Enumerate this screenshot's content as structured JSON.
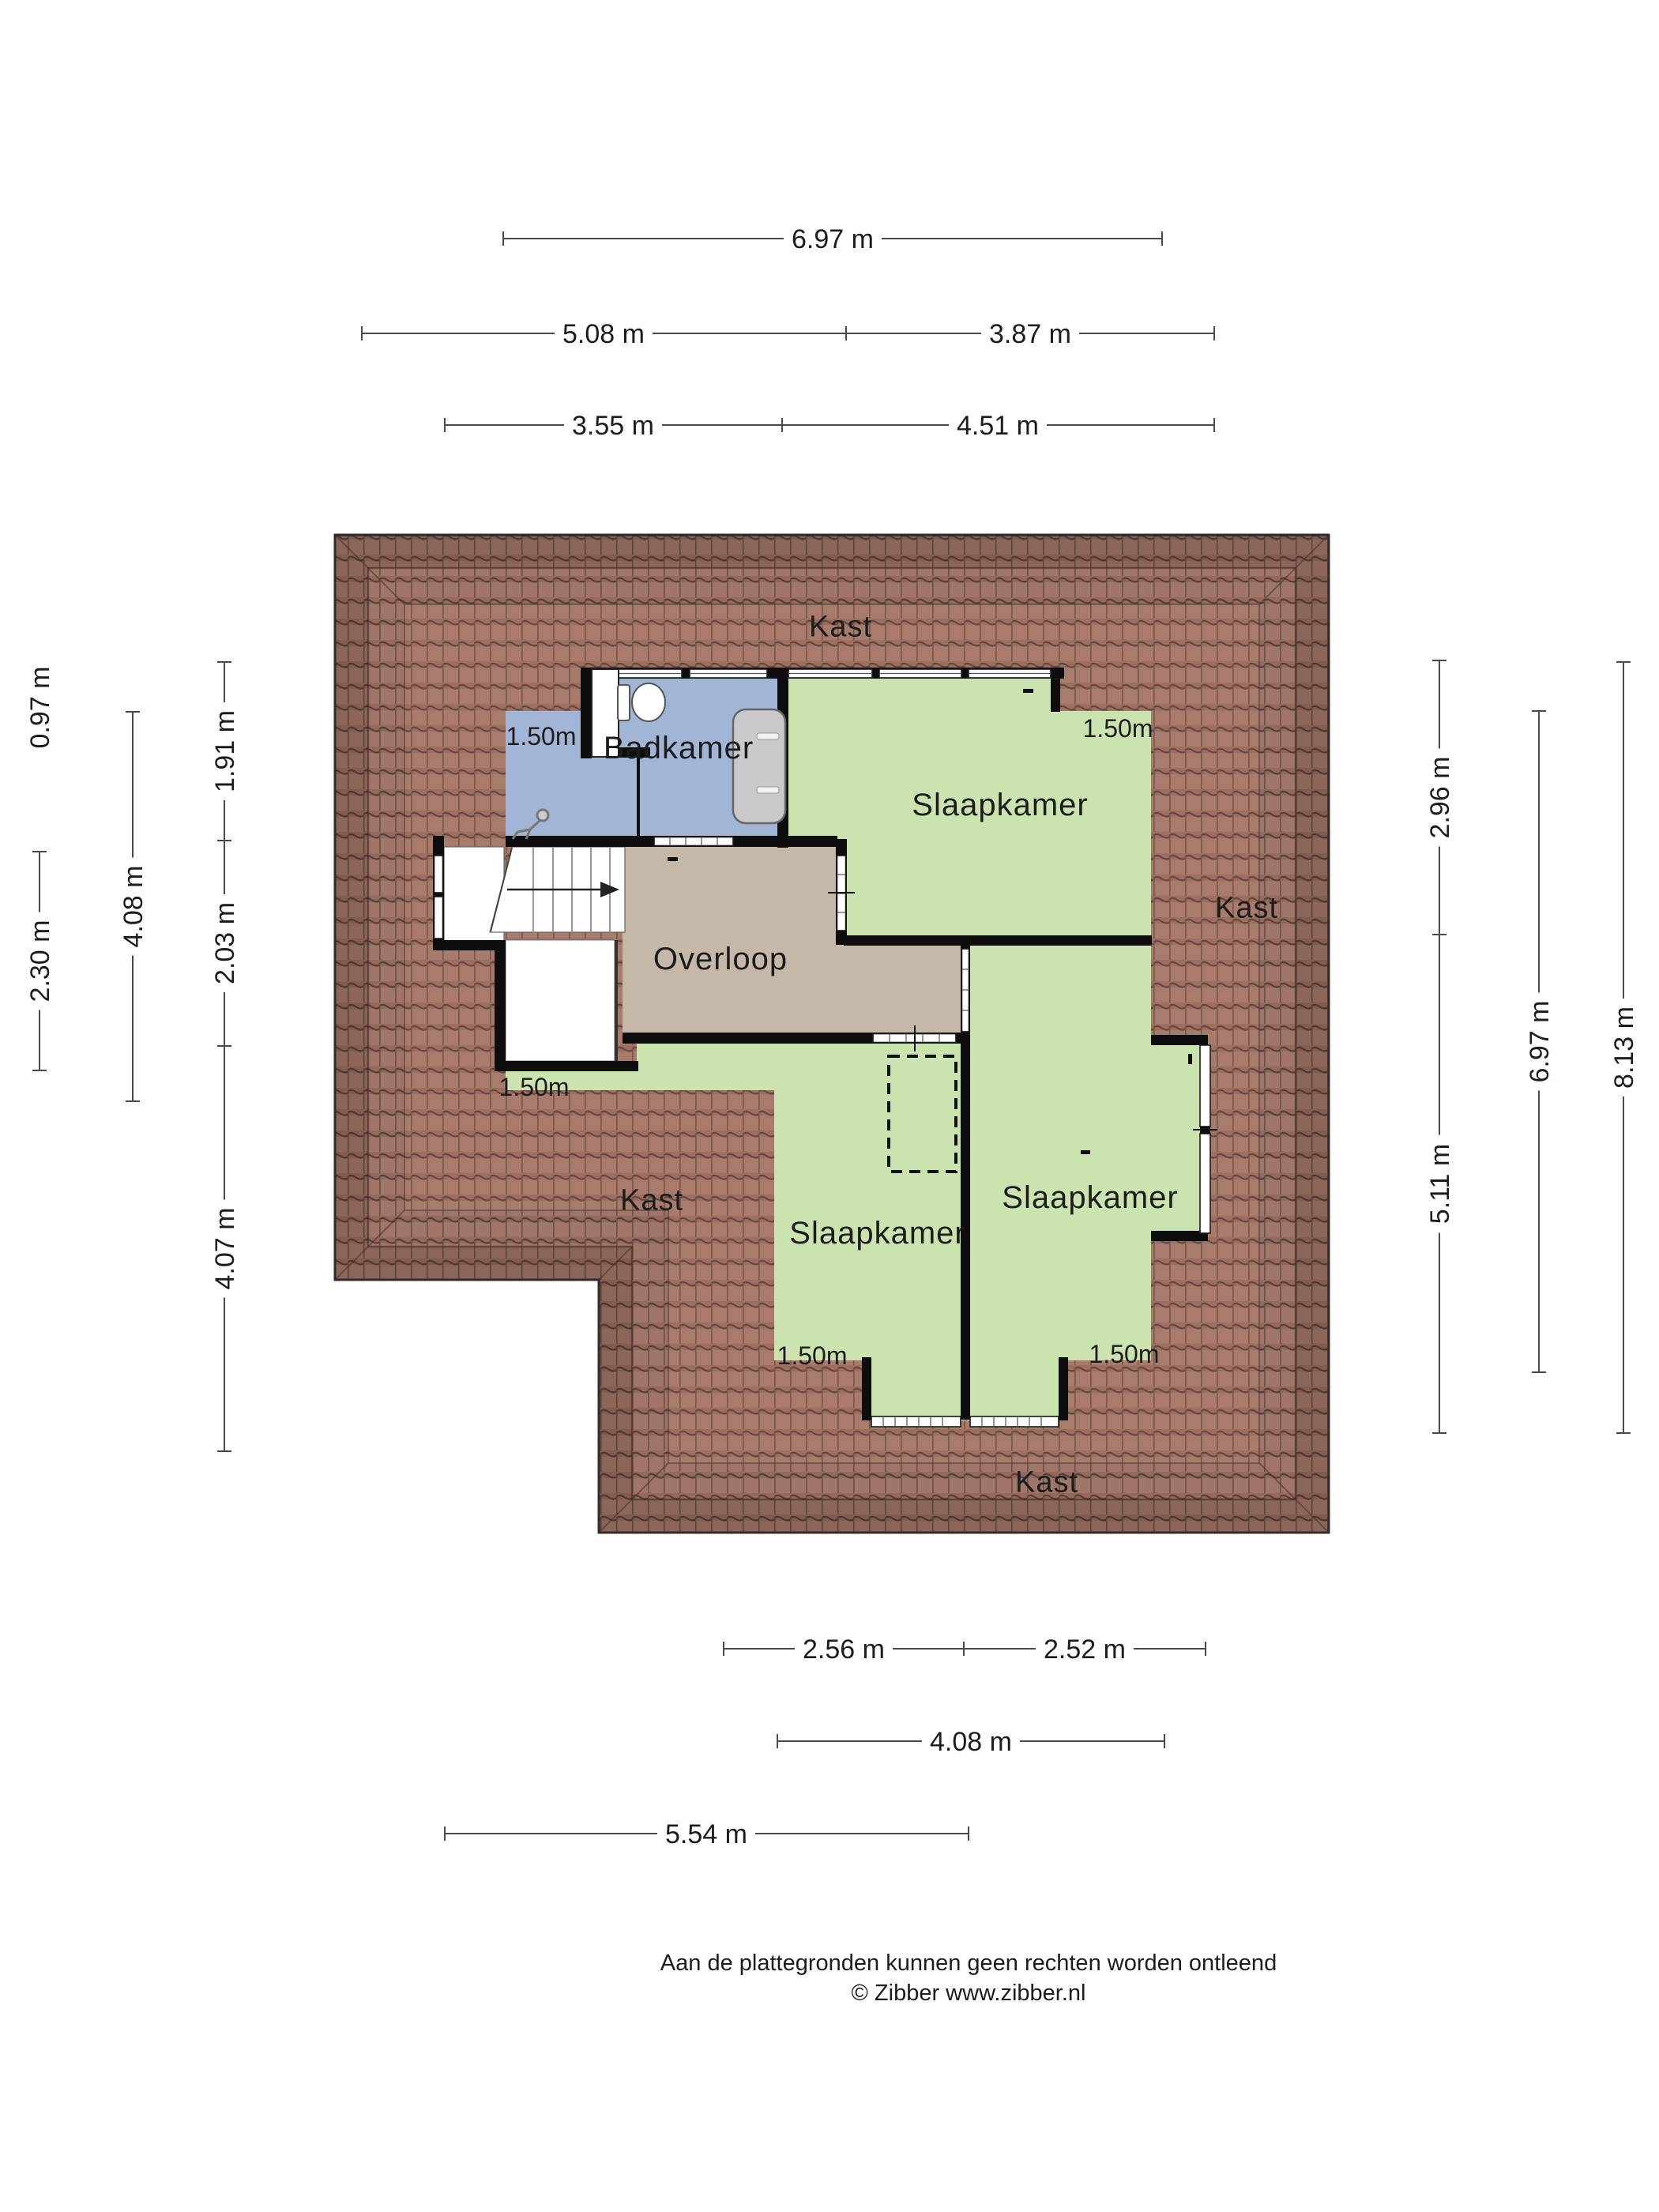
{
  "plan": {
    "room_labels": [
      {
        "id": "kast-top",
        "text": "Kast"
      },
      {
        "id": "badkamer",
        "text": "Badkamer"
      },
      {
        "id": "slaapkamer-top-right",
        "text": "Slaapkamer"
      },
      {
        "id": "kast-right",
        "text": "Kast"
      },
      {
        "id": "overloop",
        "text": "Overloop"
      },
      {
        "id": "kast-left",
        "text": "Kast"
      },
      {
        "id": "slaapkamer-bottom-middle",
        "text": "Slaapkamer"
      },
      {
        "id": "slaapkamer-bottom-right",
        "text": "Slaapkamer"
      },
      {
        "id": "kast-bottom",
        "text": "Kast"
      }
    ],
    "height_markers": [
      {
        "location": "badkamer",
        "text": "1.50m"
      },
      {
        "location": "slaapkamer-top-right",
        "text": "1.50m"
      },
      {
        "location": "overloop-left",
        "text": "1.50m"
      },
      {
        "location": "slaapkamer-bottom-middle",
        "text": "1.50m"
      },
      {
        "location": "slaapkamer-bottom-right",
        "text": "1.50m"
      }
    ]
  },
  "dimensions": {
    "top": [
      {
        "label": "6.97 m"
      },
      {
        "label": "5.08 m"
      },
      {
        "label": "3.87 m"
      },
      {
        "label": "3.55 m"
      },
      {
        "label": "4.51 m"
      }
    ],
    "bottom": [
      {
        "label": "2.56 m"
      },
      {
        "label": "2.52 m"
      },
      {
        "label": "4.08 m"
      },
      {
        "label": "5.54 m"
      }
    ],
    "left": [
      {
        "label": "0.97 m"
      },
      {
        "label": "2.30 m"
      },
      {
        "label": "4.08 m"
      },
      {
        "label": "1.91 m"
      },
      {
        "label": "2.03 m"
      },
      {
        "label": "4.07 m"
      }
    ],
    "right": [
      {
        "label": "2.96 m"
      },
      {
        "label": "5.11 m"
      },
      {
        "label": "6.97 m"
      },
      {
        "label": "8.13 m"
      }
    ]
  },
  "footer": {
    "line1": "Aan de plattegronden kunnen geen rechten worden ontleend",
    "line2": "© Zibber www.zibber.nl"
  },
  "colors": {
    "roof": "#a1766a",
    "roof_line": "#55403a",
    "bedroom_fill": "#cbe3ae",
    "bathroom_fill": "#a2b5d6",
    "hallway_fill": "#c6b8a8",
    "wall": "#0e0e0e",
    "dimension_line": "#4a4a4a"
  }
}
